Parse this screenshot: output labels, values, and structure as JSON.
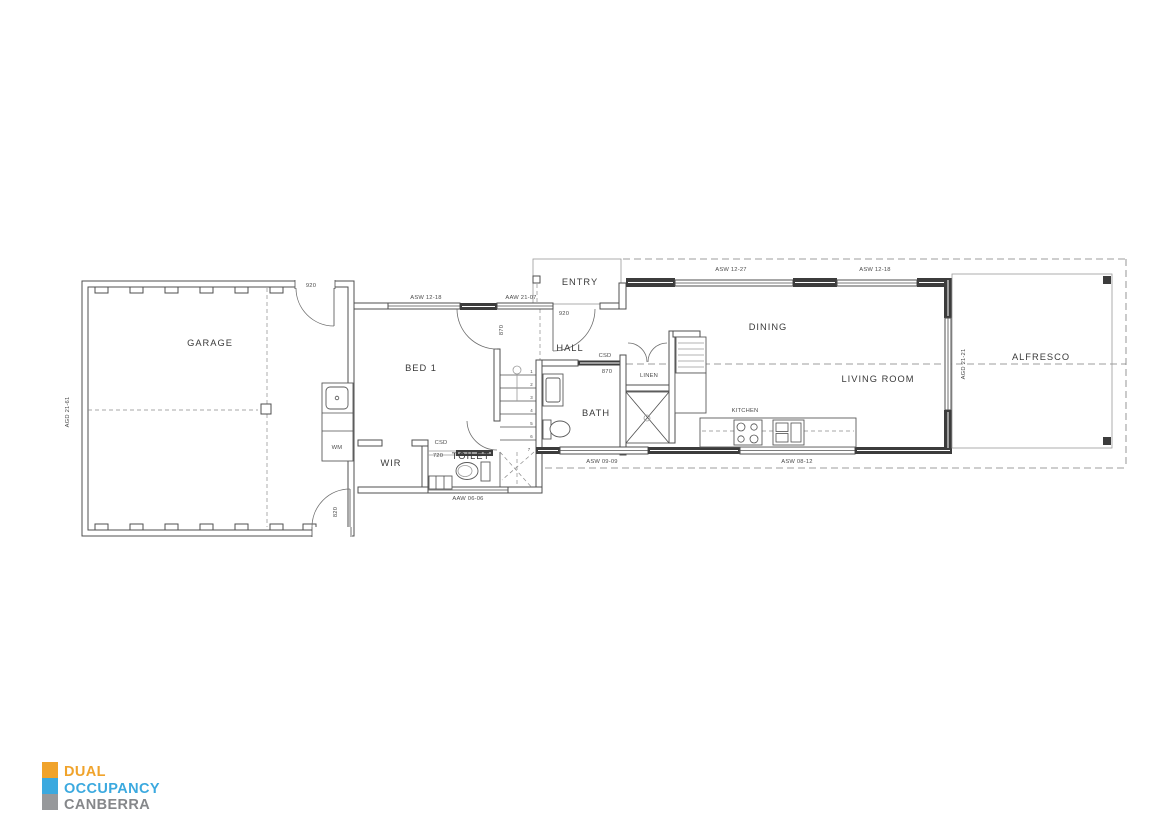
{
  "plan": {
    "rooms": {
      "garage": "GARAGE",
      "bed1": "BED 1",
      "entry": "ENTRY",
      "hall": "HALL",
      "dining": "DINING",
      "living": "LIVING ROOM",
      "alfresco": "ALFRESCO",
      "bath": "BATH",
      "wir": "WIR",
      "toilet": "TOILET",
      "linen": "LINEN",
      "kitchen": "KITCHEN",
      "wm": "WM"
    },
    "openings": {
      "garage_door_left": "AGD 21-61",
      "garage_entry_door": "920",
      "garage_rear_door": "820",
      "bed1_window": "ASW 12-18",
      "bed1_door": "870",
      "hall_window": "AAW 21-07",
      "entry_door": "920",
      "bath_door_type": "CSD",
      "bath_door_size": "870",
      "toilet_door_type": "CSD",
      "toilet_door_size": "720",
      "toilet_window": "AAW 06-06",
      "bath_window": "ASW 09-09",
      "kitchen_window": "ASW 08-12",
      "dining_window": "ASW 12-27",
      "living_window": "ASW 12-18",
      "alfresco_door": "AGD 21-21"
    },
    "stairs": {
      "treads": [
        "1",
        "2",
        "3",
        "4",
        "5",
        "6",
        "7"
      ]
    }
  },
  "logo": {
    "line1": "DUAL",
    "line2": "OCCUPANCY",
    "line3": "CANBERRA",
    "colors": {
      "orange": "#F0A32B",
      "blue": "#3BA9DF",
      "gray": "#97999B",
      "gray_text": "#85878A"
    }
  }
}
